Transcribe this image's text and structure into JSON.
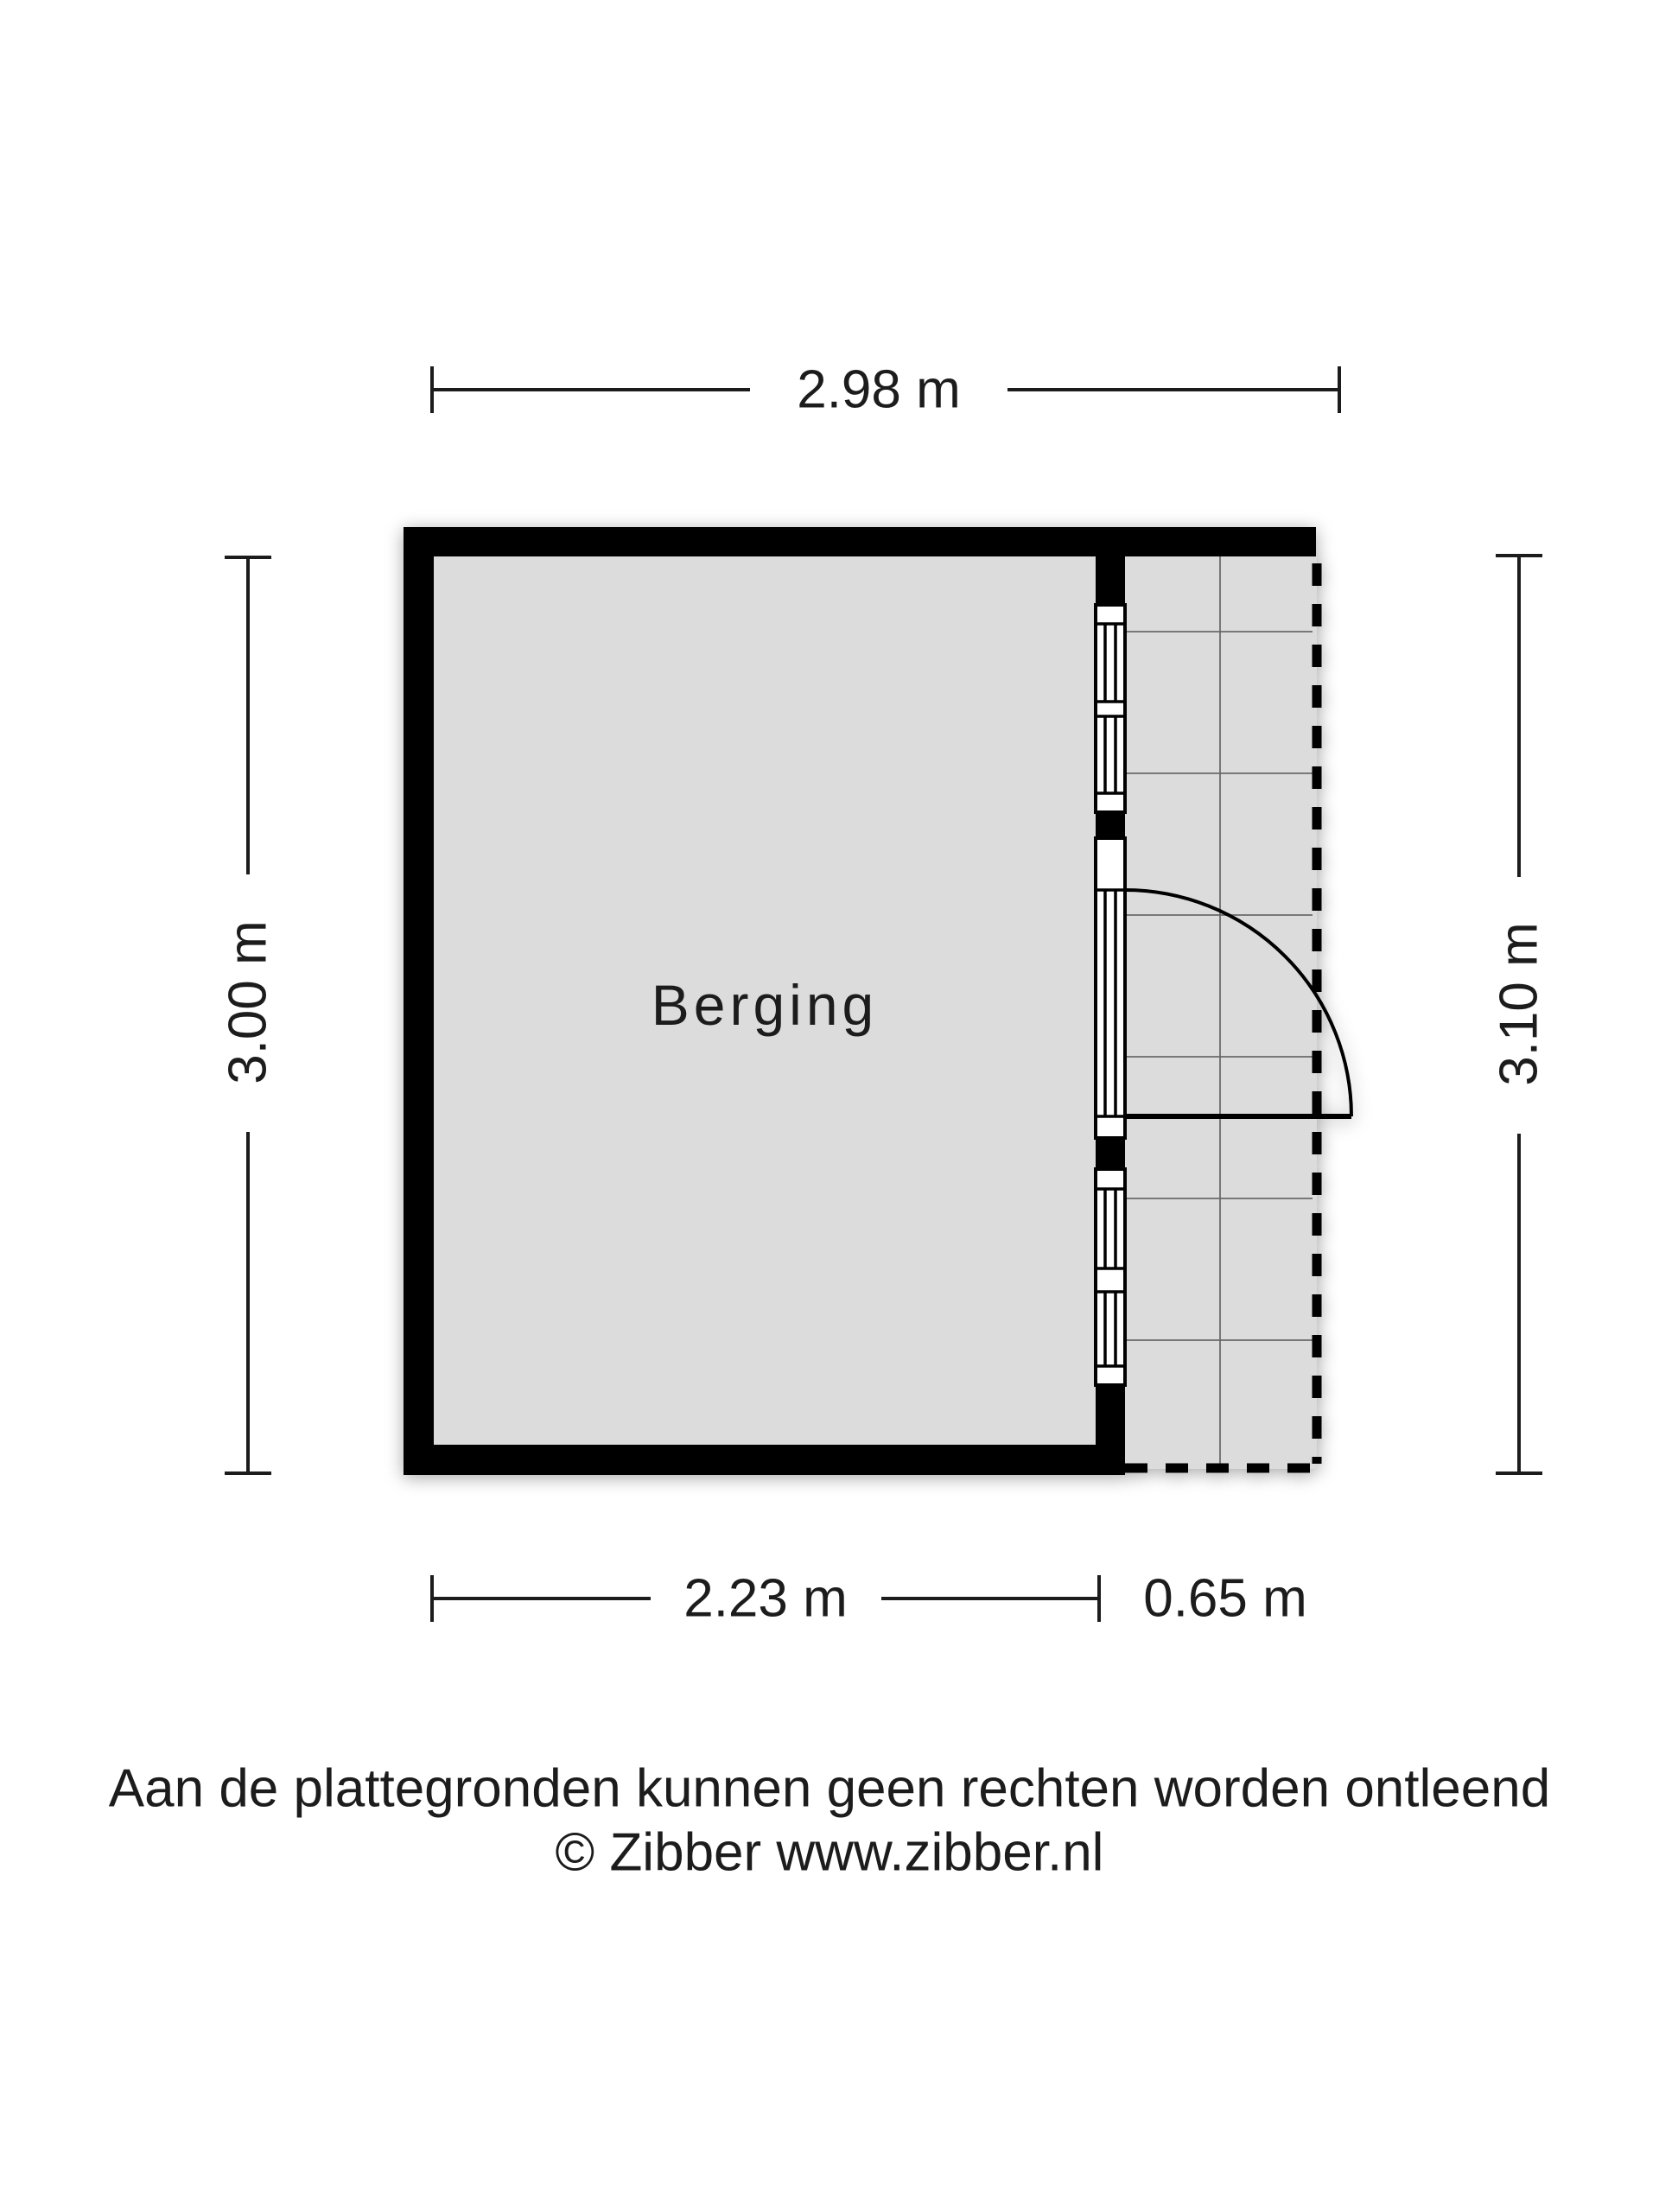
{
  "floorplan": {
    "room_label": "Berging",
    "dimensions": {
      "top_width": "2.98 m",
      "left_height": "3.00 m",
      "right_height": "3.10 m",
      "bottom_room_width": "2.23 m",
      "bottom_porch_width": "0.65 m"
    },
    "footer": {
      "disclaimer": "Aan de plattegronden kunnen geen rechten worden ontleend",
      "credit": "© Zibber www.zibber.nl"
    },
    "colors": {
      "wall": "#000000",
      "floor": "#dcdcdc",
      "background": "#ffffff",
      "grid": "#666666",
      "ink": "#1c1c1c"
    }
  }
}
